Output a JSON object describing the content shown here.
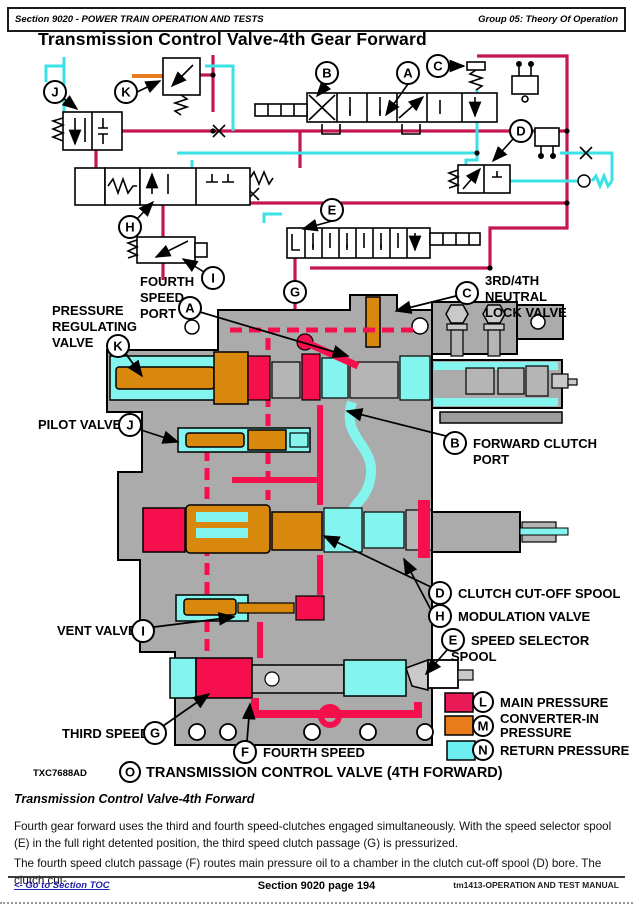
{
  "header": {
    "left": "Section 9020 - POWER TRAIN OPERATION AND TESTS",
    "right": "Group 05: Theory Of Operation"
  },
  "title": "Transmission Control Valve-4th Gear Forward",
  "diagram": {
    "schematic_callouts": [
      "J",
      "K",
      "B",
      "A",
      "C",
      "D",
      "H",
      "I",
      "E",
      "G"
    ],
    "labels": {
      "fourth_speed_port": {
        "letter": "A",
        "lines": [
          "FOURTH",
          "SPEED",
          "PORT"
        ]
      },
      "pressure_regulating_valve": {
        "letter": "K",
        "lines": [
          "PRESSURE",
          "REGULATING",
          "VALVE"
        ]
      },
      "pilot_valve": {
        "letter": "J",
        "lines": [
          "PILOT VALVE"
        ]
      },
      "vent_valve": {
        "letter": "I",
        "lines": [
          "VENT VALVE"
        ]
      },
      "third_speed": {
        "letter": "G",
        "lines": [
          "THIRD SPEED"
        ]
      },
      "fourth_speed": {
        "letter": "F",
        "lines": [
          "FOURTH SPEED"
        ]
      },
      "neutral_lock_valve": {
        "letter": "C",
        "lines": [
          "3RD/4TH",
          "NEUTRAL",
          "LOCK VALVE"
        ]
      },
      "forward_clutch_port": {
        "letter": "B",
        "lines": [
          "FORWARD CLUTCH",
          "PORT"
        ]
      },
      "clutch_cutoff_spool": {
        "letter": "D",
        "lines": [
          "CLUTCH CUT-OFF SPOOL"
        ]
      },
      "modulation_valve": {
        "letter": "H",
        "lines": [
          "MODULATION VALVE"
        ]
      },
      "speed_selector_spool": {
        "letter": "E",
        "lines": [
          "SPEED SELECTOR",
          "SPOOL"
        ]
      }
    },
    "legend": [
      {
        "letter": "L",
        "lines": [
          "MAIN PRESSURE"
        ],
        "color": "#ea1a56"
      },
      {
        "letter": "M",
        "lines": [
          "CONVERTER-IN",
          "PRESSURE"
        ],
        "color": "#e87c1a"
      },
      {
        "letter": "N",
        "lines": [
          "RETURN PRESSURE"
        ],
        "color": "#6ceef0"
      }
    ],
    "figure_code": "TXC7688AD",
    "caption_letter": "O",
    "caption": "TRANSMISSION CONTROL VALVE (4TH FORWARD)"
  },
  "body": {
    "heading": "Transmission Control Valve-4th Forward",
    "paragraphs": [
      "Fourth gear forward uses the third and fourth speed-clutches engaged simultaneously. With the speed selector spool (E) in the full right detented position, the third speed clutch passage (G) is pressurized.",
      "The fourth speed clutch passage (F) routes main pressure oil to a chamber in the clutch cut-off spool (D) bore. The clutch cut-"
    ]
  },
  "footer": {
    "toc_link": "<- Go to Section TOC",
    "center": "Section 9020 page 194",
    "right": "tm1413-OPERATION AND TEST MANUAL"
  }
}
